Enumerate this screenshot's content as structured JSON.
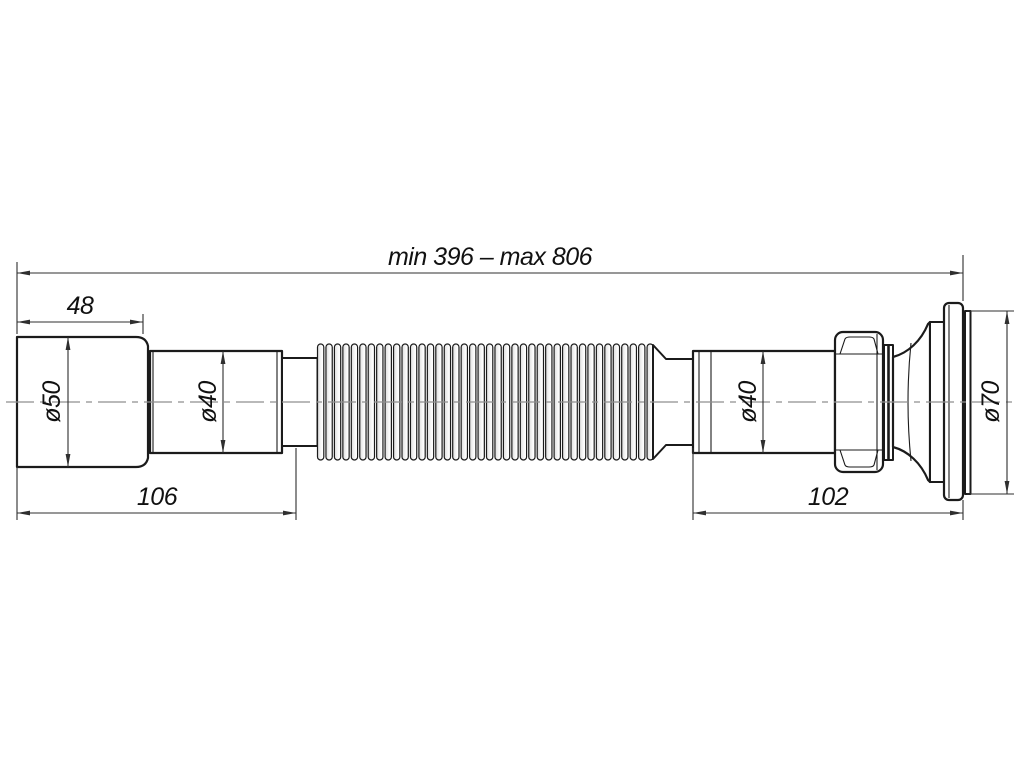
{
  "drawing": {
    "labels": {
      "overall_length": "min 396 – max 806",
      "inlet_length": "48",
      "left_body_length": "106",
      "right_body_length": "102",
      "inlet_diameter": "ø50",
      "left_pipe_diameter": "ø40",
      "right_pipe_diameter": "ø40",
      "flange_diameter": "ø70"
    },
    "colors": {
      "line": "#1b1b1b",
      "dim": "#2f2f2f",
      "centerline": "#8f8f8f",
      "background": "#ffffff",
      "rib_shade": "#dcdcdc"
    }
  }
}
